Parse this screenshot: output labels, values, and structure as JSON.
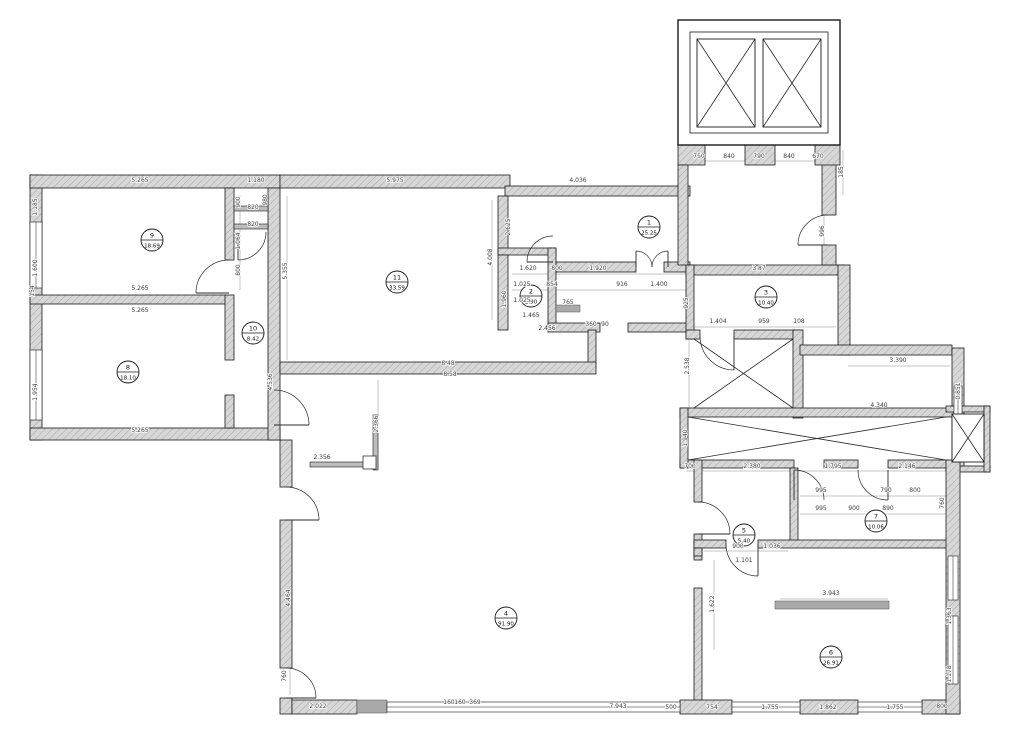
{
  "meta": {
    "drawing_type": "apartment-floor-plan",
    "background": "#ffffff",
    "wall_fill": "#d4d4d4",
    "wall_hatch": "#ababab",
    "line_color": "#1a1a1a",
    "dim_color": "#3c3c3c",
    "sill_fill": "#a9a9a9"
  },
  "rooms": [
    {
      "number": "1",
      "area": "25.25",
      "cx": 649,
      "cy": 227
    },
    {
      "number": "2",
      "area": "2.90",
      "cx": 531,
      "cy": 296
    },
    {
      "number": "3",
      "area": "10.40",
      "cx": 766,
      "cy": 297
    },
    {
      "number": "4",
      "area": "91.90",
      "cx": 506,
      "cy": 618
    },
    {
      "number": "5",
      "area": "5.40",
      "cx": 744,
      "cy": 535
    },
    {
      "number": "6",
      "area": "26.91",
      "cx": 831,
      "cy": 657
    },
    {
      "number": "7",
      "area": "10.06",
      "cx": 876,
      "cy": 521
    },
    {
      "number": "8",
      "area": "18.10",
      "cx": 128,
      "cy": 372
    },
    {
      "number": "9",
      "area": "18.69",
      "cx": 152,
      "cy": 240
    },
    {
      "number": "10",
      "area": "8.42",
      "cx": 253,
      "cy": 333
    },
    {
      "number": "11",
      "area": "33.59",
      "cx": 397,
      "cy": 282
    }
  ],
  "walls": [
    [
      30,
      175,
      12,
      265
    ],
    [
      30,
      175,
      250,
      13
    ],
    [
      280,
      175,
      230,
      13
    ],
    [
      30,
      295,
      196,
      9
    ],
    [
      30,
      428,
      250,
      12
    ],
    [
      225,
      188,
      9,
      72
    ],
    [
      225,
      295,
      9,
      65
    ],
    [
      225,
      395,
      9,
      33
    ],
    [
      268,
      188,
      12,
      252
    ],
    [
      505,
      186,
      185,
      10
    ],
    [
      498,
      196,
      10,
      59
    ],
    [
      498,
      248,
      58,
      7
    ],
    [
      548,
      248,
      8,
      82
    ],
    [
      498,
      255,
      10,
      75
    ],
    [
      556,
      262,
      80,
      10
    ],
    [
      664,
      262,
      26,
      10
    ],
    [
      548,
      323,
      52,
      9
    ],
    [
      628,
      323,
      65,
      9
    ],
    [
      588,
      330,
      8,
      34
    ],
    [
      280,
      362,
      316,
      12
    ],
    [
      686,
      265,
      158,
      10
    ],
    [
      686,
      265,
      8,
      74
    ],
    [
      822,
      150,
      14,
      65
    ],
    [
      822,
      245,
      14,
      20
    ],
    [
      678,
      145,
      27,
      20
    ],
    [
      745,
      145,
      30,
      20
    ],
    [
      815,
      145,
      25,
      20
    ],
    [
      678,
      165,
      10,
      100
    ],
    [
      686,
      330,
      14,
      9
    ],
    [
      734,
      330,
      66,
      9
    ],
    [
      793,
      330,
      10,
      88
    ],
    [
      838,
      265,
      12,
      90
    ],
    [
      800,
      345,
      152,
      10
    ],
    [
      952,
      348,
      12,
      120
    ],
    [
      680,
      408,
      278,
      9
    ],
    [
      680,
      460,
      114,
      8
    ],
    [
      824,
      460,
      34,
      8
    ],
    [
      888,
      460,
      60,
      8
    ],
    [
      680,
      408,
      8,
      60
    ],
    [
      946,
      406,
      44,
      6
    ],
    [
      946,
      466,
      44,
      6
    ],
    [
      984,
      406,
      6,
      66
    ],
    [
      694,
      460,
      8,
      42
    ],
    [
      694,
      534,
      8,
      26
    ],
    [
      790,
      468,
      8,
      77
    ],
    [
      694,
      540,
      32,
      8
    ],
    [
      758,
      540,
      192,
      8
    ],
    [
      694,
      548,
      8,
      8
    ],
    [
      694,
      588,
      8,
      122
    ],
    [
      280,
      440,
      12,
      47
    ],
    [
      280,
      520,
      12,
      148
    ],
    [
      280,
      698,
      12,
      16
    ],
    [
      292,
      700,
      65,
      14
    ],
    [
      680,
      700,
      52,
      14
    ],
    [
      800,
      700,
      58,
      14
    ],
    [
      922,
      700,
      38,
      14
    ],
    [
      946,
      460,
      14,
      254
    ]
  ],
  "thin_walls": [
    [
      234,
      206,
      34,
      5
    ],
    [
      234,
      224,
      34,
      5
    ],
    [
      373,
      415,
      5,
      55
    ],
    [
      310,
      462,
      63,
      5
    ]
  ],
  "sills": [
    [
      556,
      305,
      24,
      7
    ],
    [
      775,
      601,
      114,
      8
    ],
    [
      357,
      700,
      30,
      13
    ]
  ],
  "small_frames": [
    [
      363,
      456,
      13,
      13
    ]
  ],
  "windows": [
    {
      "x": 30,
      "y": 222,
      "w": 12,
      "h": 66,
      "o": "v"
    },
    {
      "x": 30,
      "y": 350,
      "w": 12,
      "h": 70,
      "o": "v"
    },
    {
      "x": 387,
      "y": 702,
      "w": 293,
      "h": 10,
      "o": "h"
    },
    {
      "x": 732,
      "y": 702,
      "w": 68,
      "h": 10,
      "o": "h"
    },
    {
      "x": 858,
      "y": 702,
      "w": 64,
      "h": 10,
      "o": "h"
    },
    {
      "x": 948,
      "y": 556,
      "w": 10,
      "h": 44,
      "o": "v"
    },
    {
      "x": 948,
      "y": 616,
      "w": 10,
      "h": 68,
      "o": "v"
    },
    {
      "x": 954,
      "y": 386,
      "w": 8,
      "h": 68,
      "o": "v"
    }
  ],
  "doors": [
    {
      "arc": "M 196 293 A 33 33 0 0 1 229 260",
      "leaf": [
        229,
        293,
        196,
        293
      ]
    },
    {
      "arc": "M 266 232 A 28 28 0 0 1 238 260",
      "leaf": [
        238,
        232,
        238,
        260
      ]
    },
    {
      "arc": "M 274 390 A 35 35 0 0 1 309 425",
      "leaf": [
        274,
        425,
        309,
        425
      ]
    },
    {
      "arc": "M 286 487 A 33 33 0 0 1 319 520",
      "leaf": [
        286,
        520,
        319,
        520
      ]
    },
    {
      "arc": "M 286 668 A 30 30 0 0 1 316 698",
      "leaf": [
        286,
        698,
        316,
        698
      ]
    },
    {
      "arc": "M 553 236 A 26 26 0 0 0 527 262",
      "leaf": [
        553,
        262,
        527,
        262
      ]
    },
    {
      "arc": "M 652 267 A 16 16 0 0 0 636 251",
      "leaf": [
        636,
        267,
        636,
        251
      ]
    },
    {
      "arc": "M 652 267 A 16 16 0 0 1 668 251",
      "leaf": [
        668,
        267,
        668,
        251
      ]
    },
    {
      "arc": "M 828 215 A 30 30 0 0 0 798 245",
      "leaf": [
        828,
        245,
        798,
        245
      ]
    },
    {
      "arc": "M 700 336 A 34 34 0 0 0 734 370",
      "leaf": [
        734,
        336,
        734,
        370
      ]
    },
    {
      "arc": "M 698 502 A 32 32 0 0 1 730 534",
      "leaf": [
        698,
        534,
        730,
        534
      ]
    },
    {
      "arc": "M 726 544 A 32 32 0 0 0 758 576",
      "leaf": [
        758,
        544,
        758,
        576
      ]
    },
    {
      "arc": "M 794 470 A 30 30 0 0 1 824 500",
      "leaf": [
        794,
        470,
        794,
        500
      ]
    },
    {
      "arc": "M 858 470 A 30 30 0 0 0 888 500",
      "leaf": [
        888,
        470,
        888,
        500
      ]
    }
  ],
  "elevator_block": {
    "outer": [
      678,
      20,
      162,
      125
    ],
    "inner": [
      690,
      32,
      138,
      101
    ]
  },
  "crosses": [
    {
      "x": 697,
      "y": 39,
      "w": 58,
      "h": 88,
      "box": true
    },
    {
      "x": 763,
      "y": 39,
      "w": 58,
      "h": 88,
      "box": true
    },
    {
      "x": 952,
      "y": 414,
      "w": 32,
      "h": 48,
      "box": true
    },
    {
      "x": 688,
      "y": 417,
      "w": 258,
      "h": 43,
      "box": false
    },
    {
      "x": 694,
      "y": 339,
      "w": 99,
      "h": 69,
      "box": false
    }
  ],
  "dim_lines": [
    [
      33,
      186,
      277,
      186
    ],
    [
      283,
      186,
      507,
      186
    ],
    [
      512,
      190,
      687,
      190
    ],
    [
      686,
      161,
      836,
      161
    ],
    [
      512,
      274,
      687,
      274
    ],
    [
      512,
      290,
      687,
      290
    ],
    [
      694,
      327,
      836,
      327
    ],
    [
      848,
      366,
      950,
      366
    ],
    [
      690,
      410,
      948,
      410
    ],
    [
      686,
      471,
      946,
      471
    ],
    [
      800,
      496,
      946,
      496
    ],
    [
      800,
      514,
      946,
      514
    ],
    [
      298,
      707,
      956,
      707
    ],
    [
      704,
      551,
      788,
      551
    ],
    [
      780,
      599,
      888,
      599
    ],
    [
      37,
      190,
      37,
      428
    ],
    [
      240,
      196,
      240,
      290
    ],
    [
      287,
      196,
      287,
      360
    ],
    [
      272,
      340,
      272,
      428
    ],
    [
      492,
      200,
      492,
      320
    ],
    [
      689,
      340,
      689,
      408
    ],
    [
      960,
      355,
      960,
      465
    ],
    [
      951,
      555,
      951,
      710
    ],
    [
      290,
      525,
      290,
      695
    ],
    [
      378,
      380,
      378,
      470
    ],
    [
      714,
      560,
      714,
      650
    ],
    [
      824,
      200,
      824,
      262
    ],
    [
      843,
      150,
      843,
      195
    ]
  ],
  "dims": [
    {
      "t": "5.265",
      "x": 140,
      "y": 182,
      "r": 0
    },
    {
      "t": "1.180",
      "x": 256,
      "y": 182,
      "r": 0
    },
    {
      "t": "5.975",
      "x": 395,
      "y": 182,
      "r": 0
    },
    {
      "t": "4.036",
      "x": 578,
      "y": 182,
      "r": 0
    },
    {
      "t": "750",
      "x": 699,
      "y": 158,
      "r": 0
    },
    {
      "t": "840",
      "x": 729,
      "y": 158,
      "r": 0
    },
    {
      "t": "790",
      "x": 759,
      "y": 158,
      "r": 0
    },
    {
      "t": "840",
      "x": 789,
      "y": 158,
      "r": 0
    },
    {
      "t": "670",
      "x": 818,
      "y": 158,
      "r": 0
    },
    {
      "t": "185",
      "x": 843,
      "y": 172,
      "r": -90
    },
    {
      "t": "1.185",
      "x": 37,
      "y": 207,
      "r": -90
    },
    {
      "t": "1.600",
      "x": 37,
      "y": 268,
      "r": -90
    },
    {
      "t": "154",
      "x": 34,
      "y": 291,
      "r": -90
    },
    {
      "t": "1.954",
      "x": 37,
      "y": 392,
      "r": -90
    },
    {
      "t": "5.265",
      "x": 140,
      "y": 290,
      "r": 0
    },
    {
      "t": "5.265",
      "x": 140,
      "y": 312,
      "r": 0
    },
    {
      "t": "5.265",
      "x": 140,
      "y": 432,
      "r": 0
    },
    {
      "t": "900",
      "x": 240,
      "y": 202,
      "r": -90
    },
    {
      "t": "820",
      "x": 253,
      "y": 209,
      "r": 0
    },
    {
      "t": "820",
      "x": 253,
      "y": 226,
      "r": 0
    },
    {
      "t": "980",
      "x": 267,
      "y": 200,
      "r": -90
    },
    {
      "t": "1.064",
      "x": 240,
      "y": 241,
      "r": -90
    },
    {
      "t": "800",
      "x": 240,
      "y": 270,
      "r": -90
    },
    {
      "t": "5.355",
      "x": 287,
      "y": 271,
      "r": -90
    },
    {
      "t": "4.536",
      "x": 272,
      "y": 382,
      "r": -90
    },
    {
      "t": "8.48",
      "x": 448,
      "y": 365,
      "r": 0
    },
    {
      "t": "8.58",
      "x": 450,
      "y": 376,
      "r": 0
    },
    {
      "t": "4.008",
      "x": 492,
      "y": 257,
      "r": -90
    },
    {
      "t": "2.625",
      "x": 510,
      "y": 227,
      "r": -90
    },
    {
      "t": "1.620",
      "x": 528,
      "y": 270,
      "r": 0
    },
    {
      "t": "800",
      "x": 557,
      "y": 270,
      "r": 0
    },
    {
      "t": "1.920",
      "x": 598,
      "y": 270,
      "r": 0
    },
    {
      "t": "1.025",
      "x": 522,
      "y": 286,
      "r": 0
    },
    {
      "t": "854",
      "x": 552,
      "y": 286,
      "r": 0
    },
    {
      "t": "916",
      "x": 622,
      "y": 286,
      "r": 0
    },
    {
      "t": "1.400",
      "x": 659,
      "y": 286,
      "r": 0
    },
    {
      "t": "1.025",
      "x": 522,
      "y": 302,
      "r": 0
    },
    {
      "t": "765",
      "x": 568,
      "y": 304,
      "r": 0
    },
    {
      "t": "1.465",
      "x": 531,
      "y": 317,
      "r": 0
    },
    {
      "t": "2.456",
      "x": 547,
      "y": 330,
      "r": 0
    },
    {
      "t": "360",
      "x": 591,
      "y": 326,
      "r": 0
    },
    {
      "t": "90",
      "x": 605,
      "y": 326,
      "r": 0
    },
    {
      "t": "1.960",
      "x": 506,
      "y": 299,
      "r": -90
    },
    {
      "t": "925",
      "x": 688,
      "y": 303,
      "r": -90
    },
    {
      "t": "3.87",
      "x": 759,
      "y": 270,
      "r": 0
    },
    {
      "t": "1.404",
      "x": 718,
      "y": 323,
      "r": 0
    },
    {
      "t": "959",
      "x": 764,
      "y": 323,
      "r": 0
    },
    {
      "t": "108",
      "x": 799,
      "y": 323,
      "r": 0
    },
    {
      "t": "2.538",
      "x": 689,
      "y": 366,
      "r": -90
    },
    {
      "t": "1.940",
      "x": 687,
      "y": 438,
      "r": -90
    },
    {
      "t": "3.390",
      "x": 898,
      "y": 362,
      "r": 0
    },
    {
      "t": "4.340",
      "x": 879,
      "y": 407,
      "r": 0
    },
    {
      "t": "0.851",
      "x": 960,
      "y": 391,
      "r": -90
    },
    {
      "t": "700",
      "x": 690,
      "y": 468,
      "r": 0
    },
    {
      "t": "2.380",
      "x": 752,
      "y": 468,
      "r": 0
    },
    {
      "t": "1.795",
      "x": 833,
      "y": 468,
      "r": 0
    },
    {
      "t": "2.146",
      "x": 907,
      "y": 468,
      "r": 0
    },
    {
      "t": "995",
      "x": 821,
      "y": 492,
      "r": 0
    },
    {
      "t": "790",
      "x": 886,
      "y": 492,
      "r": 0
    },
    {
      "t": "800",
      "x": 915,
      "y": 492,
      "r": 0
    },
    {
      "t": "995",
      "x": 821,
      "y": 510,
      "r": 0
    },
    {
      "t": "900",
      "x": 854,
      "y": 510,
      "r": 0
    },
    {
      "t": "890",
      "x": 888,
      "y": 510,
      "r": 0
    },
    {
      "t": "760",
      "x": 944,
      "y": 503,
      "r": -90
    },
    {
      "t": "900",
      "x": 738,
      "y": 548,
      "r": 0
    },
    {
      "t": "1.036",
      "x": 772,
      "y": 548,
      "r": 0
    },
    {
      "t": "1.101",
      "x": 744,
      "y": 562,
      "r": 0
    },
    {
      "t": "3.943",
      "x": 831,
      "y": 595,
      "r": 0
    },
    {
      "t": "1.622",
      "x": 714,
      "y": 604,
      "r": -90
    },
    {
      "t": "1.363",
      "x": 951,
      "y": 616,
      "r": -90
    },
    {
      "t": "1.178",
      "x": 951,
      "y": 674,
      "r": -90
    },
    {
      "t": "2.366",
      "x": 378,
      "y": 424,
      "r": -90
    },
    {
      "t": "2.356",
      "x": 322,
      "y": 459,
      "r": 0
    },
    {
      "t": "4.464",
      "x": 290,
      "y": 598,
      "r": -90
    },
    {
      "t": "760",
      "x": 286,
      "y": 676,
      "r": -90
    },
    {
      "t": "2.022",
      "x": 318,
      "y": 708,
      "r": 0
    },
    {
      "t": "160",
      "x": 449,
      "y": 704,
      "r": 0
    },
    {
      "t": "160",
      "x": 460,
      "y": 704,
      "r": 0
    },
    {
      "t": "369",
      "x": 475,
      "y": 704,
      "r": 0
    },
    {
      "t": "7.943",
      "x": 618,
      "y": 708,
      "r": 0
    },
    {
      "t": "500",
      "x": 671,
      "y": 709,
      "r": 0
    },
    {
      "t": "754",
      "x": 712,
      "y": 709,
      "r": 0
    },
    {
      "t": "1.755",
      "x": 770,
      "y": 709,
      "r": 0
    },
    {
      "t": "1.862",
      "x": 828,
      "y": 709,
      "r": 0
    },
    {
      "t": "1.755",
      "x": 895,
      "y": 709,
      "r": 0
    },
    {
      "t": "800",
      "x": 942,
      "y": 708,
      "r": 0
    },
    {
      "t": "996",
      "x": 824,
      "y": 231,
      "r": -90
    }
  ]
}
